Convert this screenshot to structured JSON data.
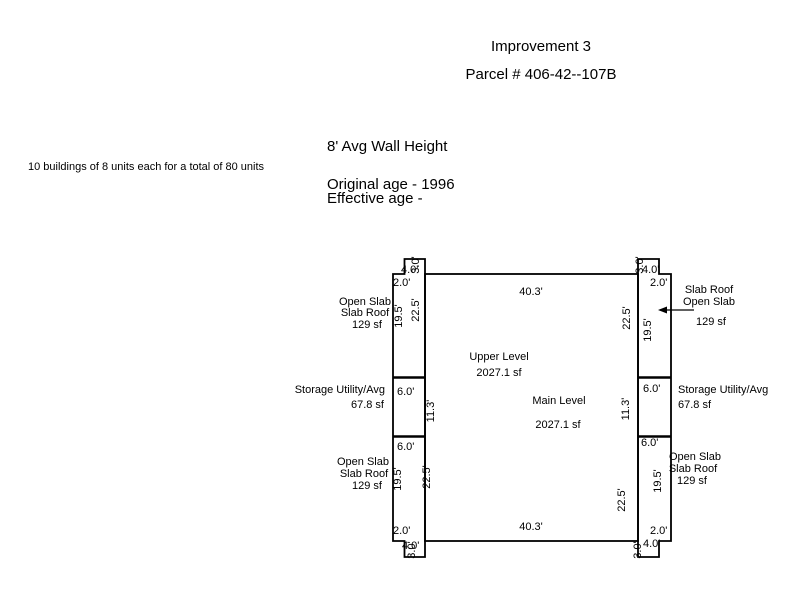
{
  "header": {
    "improvement_title": "Improvement 3",
    "parcel_number": "Parcel # 406-42--107B"
  },
  "details": {
    "wall_height": "8' Avg Wall Height",
    "buildings_note": "10 buildings of 8 units each for a total of 80 units",
    "original_age": "Original age - 1996",
    "effective_age": "Effective age -"
  },
  "sketch": {
    "levels": {
      "upper_label": "Upper Level",
      "upper_area": "2027.1 sf",
      "main_label": "Main Level",
      "main_area": "2027.1 sf"
    },
    "dims": {
      "width": "40.3'",
      "wall_seg": "22.5'",
      "slab_len": "19.5'",
      "storage_len": "11.3'",
      "wing_width": "6.0'",
      "edge_small": "2.0'",
      "notch_width": "4.0'",
      "notch_height": "3.0'"
    },
    "annotations": {
      "left_top": {
        "line1": "Open Slab",
        "line2": "Slab Roof",
        "area": "129 sf"
      },
      "left_mid": {
        "line1": "Storage Utility/Avg",
        "area": "67.8 sf"
      },
      "left_bottom": {
        "line1": "Open Slab",
        "line2": "Slab Roof",
        "area": "129 sf"
      },
      "right_top": {
        "line1": "Slab Roof",
        "line2": "Open Slab",
        "area": "129 sf"
      },
      "right_mid": {
        "line1": "Storage Utility/Avg",
        "area": "67.8 sf"
      },
      "right_bottom": {
        "line1": "Open Slab",
        "line2": "Slab Roof",
        "area": "129 sf"
      }
    },
    "colors": {
      "line": "#000000",
      "background": "#ffffff"
    }
  }
}
